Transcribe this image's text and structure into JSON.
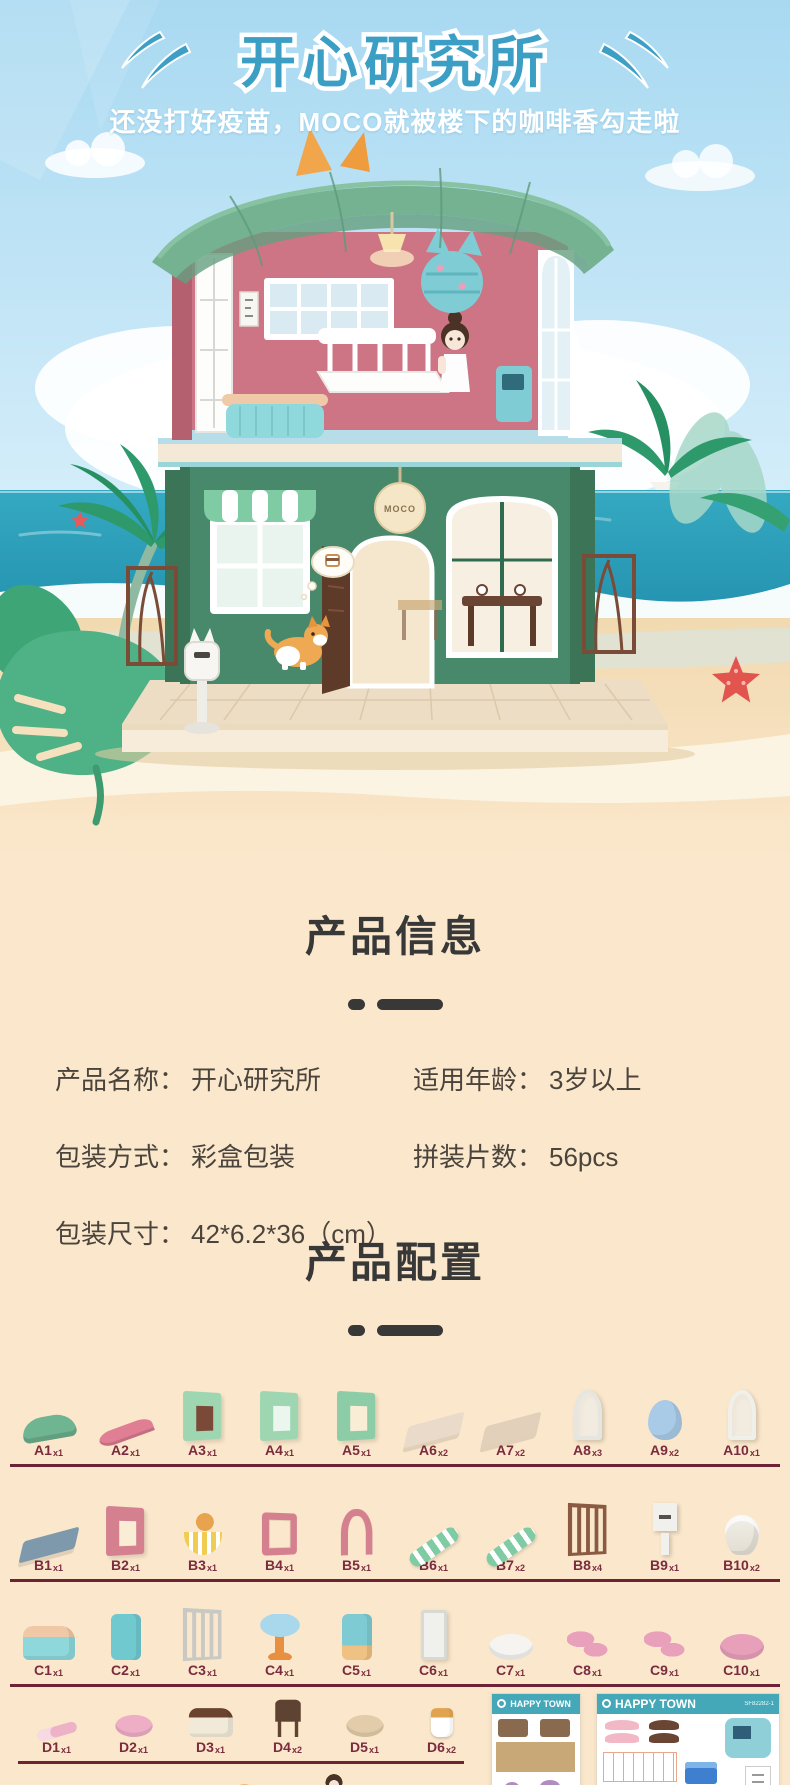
{
  "header": {
    "title": "开心研究所",
    "subtitle": "还没打好疫苗，MOCO就被楼下的咖啡香勾走啦"
  },
  "hero": {
    "house_sign": "MOCO"
  },
  "product_info": {
    "heading": "产品信息",
    "fields": [
      {
        "key": "name",
        "label": "产品名称：",
        "value": "开心研究所"
      },
      {
        "key": "age",
        "label": "适用年龄：",
        "value": "3岁以上"
      },
      {
        "key": "pack",
        "label": "包装方式：",
        "value": "彩盒包装"
      },
      {
        "key": "pcs",
        "label": "拼装片数：",
        "value": "56pcs"
      },
      {
        "key": "size",
        "label": "包装尺寸：",
        "value": "42*6.2*36（cm）"
      }
    ]
  },
  "product_config": {
    "heading": "产品配置",
    "rows": [
      {
        "id": "a",
        "items": [
          {
            "code": "A1",
            "count": "x1",
            "icon": "green-roof-arch-icon",
            "shape": "roof",
            "c1": "#6FB592"
          },
          {
            "code": "A2",
            "count": "x1",
            "icon": "pink-roof-slope-icon",
            "shape": "slope",
            "c1": "#E07E93"
          },
          {
            "code": "A3",
            "count": "x1",
            "icon": "door-wall-panel-icon",
            "shape": "wall",
            "c1": "#9ED6B2",
            "c2": "#7A4938"
          },
          {
            "code": "A4",
            "count": "x1",
            "icon": "window-wall-panel-icon",
            "shape": "wall",
            "c1": "#9ED6B2",
            "c2": "#EAF6EE"
          },
          {
            "code": "A5",
            "count": "x1",
            "icon": "opening-wall-panel-icon",
            "shape": "wall",
            "c1": "#8CCDA8",
            "c2": "#F9EDD6"
          },
          {
            "code": "A6",
            "count": "x2",
            "icon": "floor-panel-icon",
            "shape": "panel",
            "c1": "#E9DACA"
          },
          {
            "code": "A7",
            "count": "x2",
            "icon": "lattice-floor-panel-icon",
            "shape": "panel",
            "c1": "#E2D0BA"
          },
          {
            "code": "A8",
            "count": "x3",
            "icon": "arched-window-frame-icon",
            "shape": "archwin",
            "c1": "#E6E6E1"
          },
          {
            "code": "A9",
            "count": "x2",
            "icon": "blue-dome-icon",
            "shape": "dome",
            "c1": "#A9CBE7"
          },
          {
            "code": "A10",
            "count": "x1",
            "icon": "corner-window-icon",
            "shape": "archwin",
            "c1": "#F0F0EB"
          }
        ]
      },
      {
        "id": "b",
        "items": [
          {
            "code": "B1",
            "count": "x1",
            "icon": "base-beam-icon",
            "shape": "panel",
            "c1": "#7E99AC"
          },
          {
            "code": "B2",
            "count": "x1",
            "icon": "pink-window-wall-icon",
            "shape": "wall",
            "c1": "#D4808F",
            "c2": "#F9EDD6"
          },
          {
            "code": "B3",
            "count": "x1",
            "icon": "balcony-corgi-icon",
            "shape": "balcony",
            "c1": "#F1CC52",
            "c2": "#E8A34E"
          },
          {
            "code": "B4",
            "count": "x1",
            "icon": "pink-frame-icon",
            "shape": "frame",
            "c1": "#D4808F"
          },
          {
            "code": "B5",
            "count": "x1",
            "icon": "pink-arch-doorway-icon",
            "shape": "arch",
            "c1": "#D4808F"
          },
          {
            "code": "B6",
            "count": "x1",
            "icon": "awning-strip-icon",
            "shape": "stripe",
            "c1": "#7ECBA4"
          },
          {
            "code": "B7",
            "count": "x2",
            "icon": "awning-icon",
            "shape": "stripe",
            "c1": "#7ECBA4"
          },
          {
            "code": "B8",
            "count": "x4",
            "icon": "garden-fence-icon",
            "shape": "fence",
            "c1": "#8A5A42"
          },
          {
            "code": "B9",
            "count": "x1",
            "icon": "mailbox-icon",
            "shape": "mailbox",
            "c1": "#F1F0EC",
            "c2": "#55504B"
          },
          {
            "code": "B10",
            "count": "x2",
            "icon": "pedestal-table-icon",
            "shape": "planter",
            "c1": "#F1EFE9"
          }
        ]
      },
      {
        "id": "c",
        "items": [
          {
            "code": "C1",
            "count": "x1",
            "icon": "reception-counter-icon",
            "shape": "counter",
            "c1": "#8ED8DB",
            "c2": "#F0C8A6"
          },
          {
            "code": "C2",
            "count": "x1",
            "icon": "cat-shelf-icon",
            "shape": "machine",
            "c1": "#6FC9CF",
            "c2": "#6FC9CF"
          },
          {
            "code": "C3",
            "count": "x1",
            "icon": "fence-divider-icon",
            "shape": "fence",
            "c1": "#C9C9C4"
          },
          {
            "code": "C4",
            "count": "x1",
            "icon": "round-table-icon",
            "shape": "table",
            "c1": "#A9D8ED",
            "c2": "#E8903F"
          },
          {
            "code": "C5",
            "count": "x1",
            "icon": "coffee-machine-icon",
            "shape": "machine",
            "c1": "#7FCBD3",
            "c2": "#EFC183"
          },
          {
            "code": "C6",
            "count": "x1",
            "icon": "display-board-icon",
            "shape": "tall",
            "c1": "#F0F0EC"
          },
          {
            "code": "C7",
            "count": "x1",
            "icon": "tray-icon",
            "shape": "blob",
            "c1": "#F5F4F0"
          },
          {
            "code": "C8",
            "count": "x1",
            "icon": "pink-accessories-icon",
            "shape": "pieces",
            "c1": "#E8A0BB"
          },
          {
            "code": "C9",
            "count": "x1",
            "icon": "pink-accessories-2-icon",
            "shape": "pieces",
            "c1": "#E8A0BB"
          },
          {
            "code": "C10",
            "count": "x1",
            "icon": "pink-holder-icon",
            "shape": "blob",
            "c1": "#E89FBA"
          }
        ]
      },
      {
        "id": "d",
        "items": [
          {
            "code": "D1",
            "count": "x1",
            "icon": "thermometer-icon",
            "shape": "thermo",
            "c1": "#EDB2C7"
          },
          {
            "code": "D2",
            "count": "x1",
            "icon": "basin-icon",
            "shape": "blob",
            "c1": "#EEAEC5"
          },
          {
            "code": "D3",
            "count": "x1",
            "icon": "cake-counter-icon",
            "shape": "counter",
            "c1": "#F2EAD8",
            "c2": "#6B4430"
          },
          {
            "code": "D4",
            "count": "x2",
            "icon": "chair-icon",
            "shape": "chair",
            "c1": "#5F4332"
          },
          {
            "code": "D5",
            "count": "x1",
            "icon": "bread-basket-icon",
            "shape": "blob",
            "c1": "#E2CCA9"
          },
          {
            "code": "D6",
            "count": "x2",
            "icon": "coffee-cup-icon",
            "shape": "cup",
            "c1": "#FFFFFF",
            "c2": "#E2A350"
          }
        ]
      },
      {
        "id": "e",
        "items": [
          {
            "code": "E1",
            "count": "x2",
            "icon": "croissant-icon",
            "shape": "croissant",
            "c1": "#E9B277"
          },
          {
            "code": "E2",
            "count": "x2",
            "icon": "baguette-icon",
            "shape": "slope",
            "c1": "#E3AA6D"
          },
          {
            "code": "E3",
            "count": "x2",
            "icon": "donut-icon",
            "shape": "donut",
            "c1": "#E8A763"
          },
          {
            "code": "E4",
            "count": "x1",
            "icon": "girl-figure-icon",
            "shape": "figure",
            "c1": "#F4C6D4",
            "c2": "#4A3226"
          },
          {
            "code": "E5",
            "count": "x1",
            "icon": "corgi-figure-icon",
            "shape": "dog",
            "c1": "#E8A34E",
            "c2": "#FFFFFF"
          }
        ]
      }
    ],
    "sheets": [
      {
        "title": "HAPPY TOWN",
        "caption": "1-1/2/3/4/5/6/7"
      },
      {
        "title": "HAPPY TOWN",
        "code": "SF82282-1",
        "caption": "1-8/9/10/11/12/13/14"
      }
    ]
  },
  "palette": {
    "title_teal": "#3B9EC4",
    "sky_blue": "#A8D9F1",
    "ocean_teal": "#2FA6C0",
    "sand_cream": "#FBE8CC",
    "heading_dark": "#383838",
    "label_maroon": "#7B2B3E",
    "divider_maroon": "#6E2335",
    "sheet_teal": "#45A8B8"
  }
}
